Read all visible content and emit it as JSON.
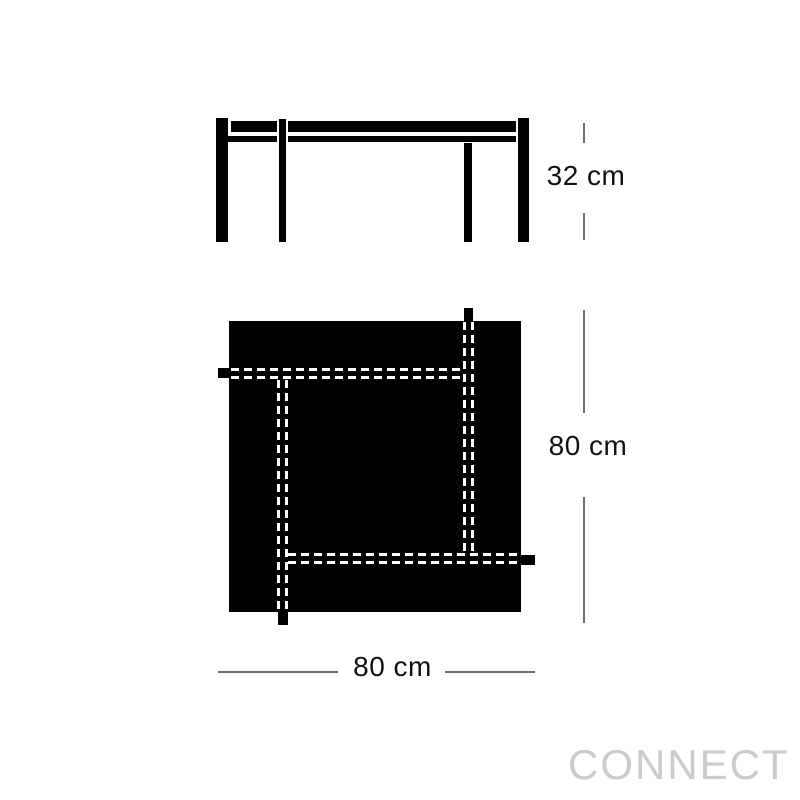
{
  "dimensions": {
    "height_label": "32 cm",
    "depth_label": "80 cm",
    "width_label": "80 cm"
  },
  "watermark": {
    "label": "CONNECT"
  },
  "colors": {
    "background": "#ffffff",
    "drawing": "#000000",
    "dash": "#ffffff",
    "dimension_line": "#6e6e6e",
    "text": "#111111",
    "watermark": "#cbcbcb"
  }
}
